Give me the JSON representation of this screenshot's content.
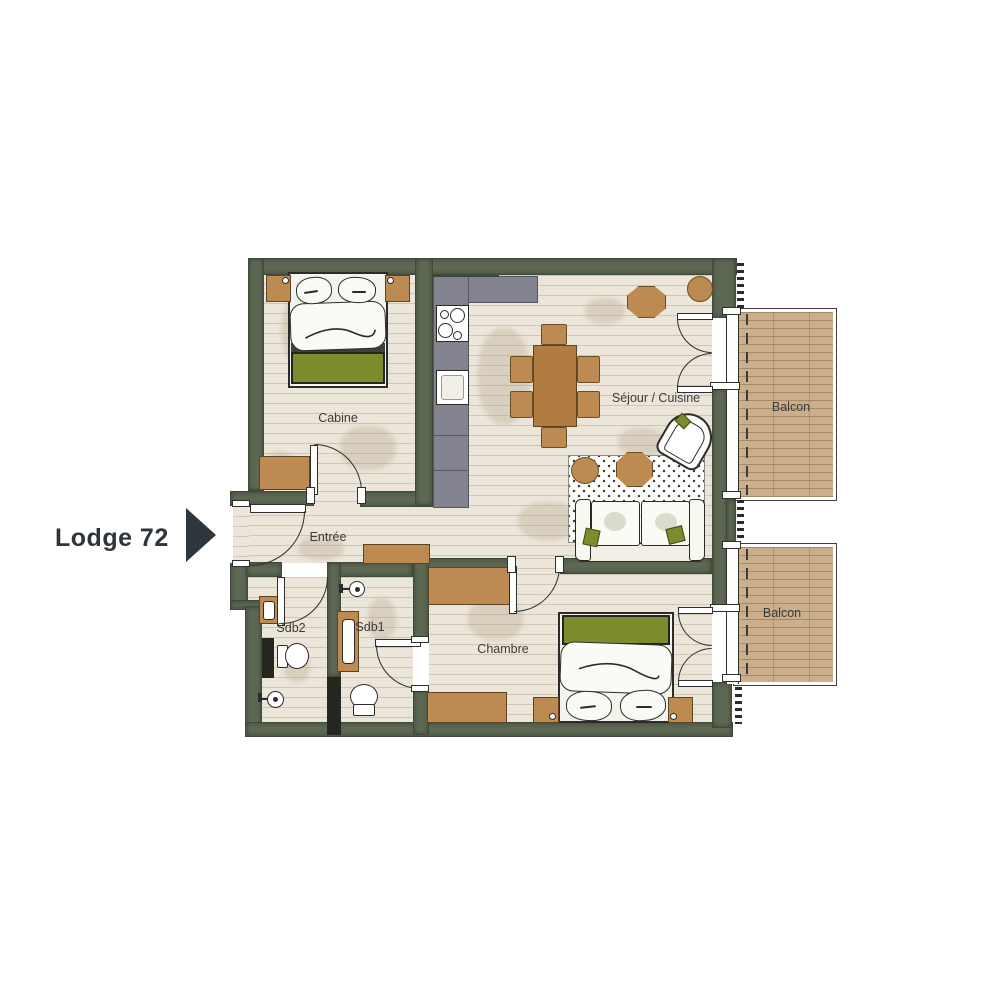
{
  "title": {
    "label": "Lodge 72",
    "marker": "right-arrow"
  },
  "rooms": {
    "cabine": {
      "label": "Cabine"
    },
    "entree": {
      "label": "Entrée"
    },
    "sdb2": {
      "label": "Sdb2"
    },
    "sdb1": {
      "label": "Sdb1"
    },
    "chambre": {
      "label": "Chambre"
    },
    "sejour": {
      "label": "Séjour / Cuisine"
    },
    "balcon1": {
      "label": "Balcon"
    },
    "balcon2": {
      "label": "Balcon"
    }
  },
  "colors": {
    "wall": "#5d6853",
    "walldark": "#3c453b",
    "partition": "#24261f",
    "floor": "#ebe5da",
    "kitchen": "#82838e",
    "wood": "#b07c3f",
    "woodlight": "#bd8a52",
    "woodborder": "#5e4421",
    "deck": "#cbae8b",
    "green": "#7c8b2b",
    "outline": "#2b2b2b",
    "label": "#3b3b3b",
    "title": "#2e363b"
  }
}
